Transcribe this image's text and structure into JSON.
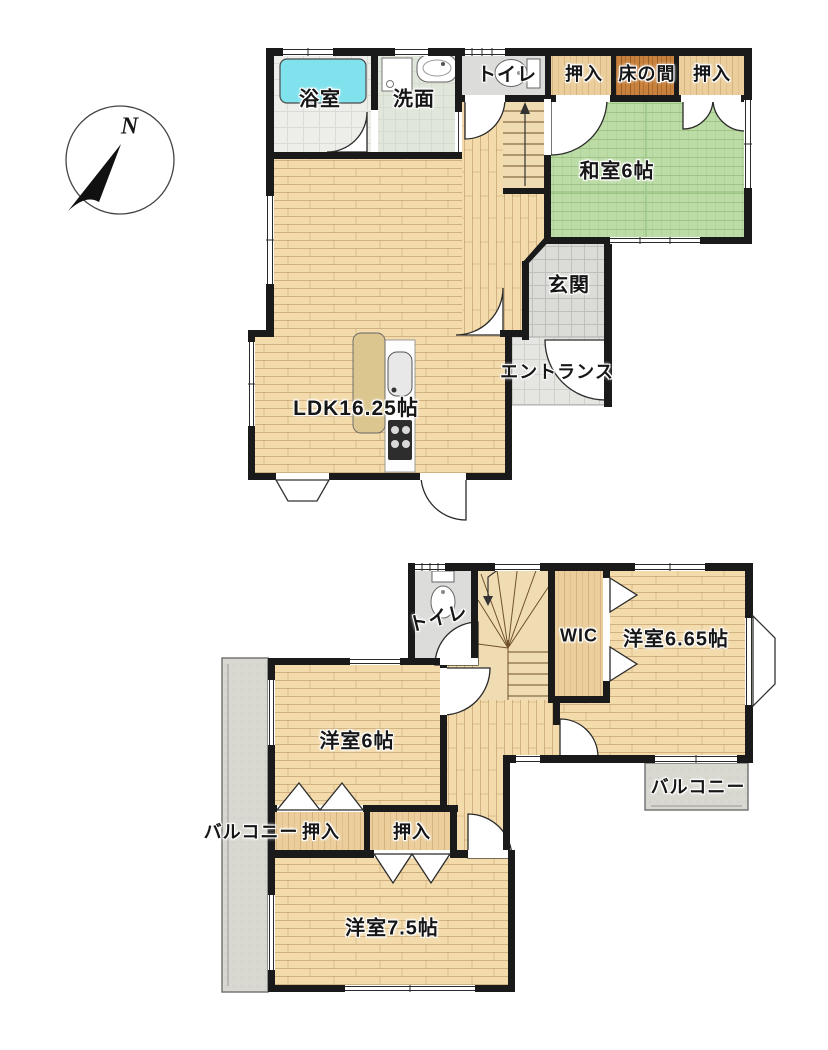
{
  "compass": {
    "north_label": "N"
  },
  "floor1": {
    "bathroom": "浴室",
    "washroom": "洗面",
    "toilet": "トイレ",
    "closet_a": "押入",
    "tokonoma": "床の間",
    "closet_b": "押入",
    "japanese_room": "和室6帖",
    "genkan": "玄関",
    "entrance": "エントランス",
    "ldk": "LDK16.25帖"
  },
  "floor2": {
    "toilet": "トイレ",
    "wic": "WIC",
    "western_room_665": "洋室6.65帖",
    "western_room_6": "洋室6帖",
    "balcony_left": "バルコニー",
    "closet_a": "押入",
    "closet_b": "押入",
    "western_room_75": "洋室7.5帖",
    "balcony_right": "バルコニー"
  },
  "colors": {
    "wall": "#1a1a1a",
    "wood_floor": "#f2daab",
    "tatami_green": "#bcdca6",
    "bathtub_cyan": "#7fe2ec",
    "tile_gray": "#dbdbd7",
    "closet_wood": "#ebce9c",
    "tokonoma_wood": "#c9823d",
    "balcony_gray": "#d9d8d0"
  }
}
